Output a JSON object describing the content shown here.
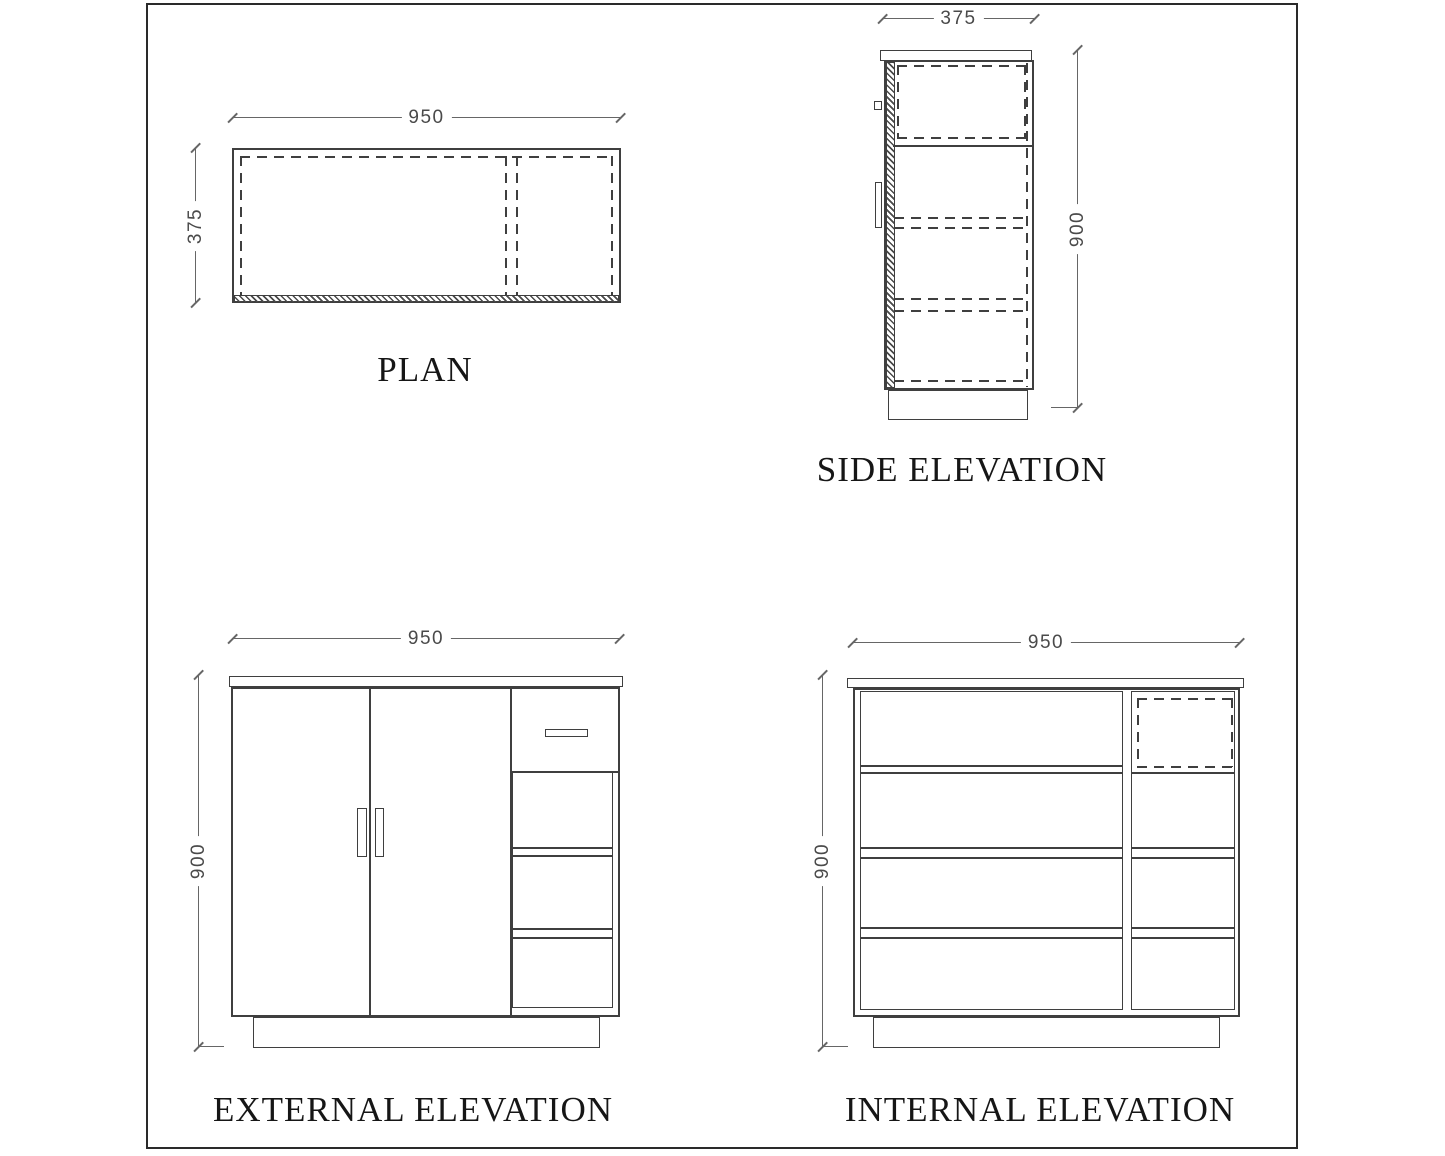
{
  "views": {
    "plan": {
      "title": "PLAN",
      "width_dim": "950",
      "depth_dim": "375"
    },
    "side": {
      "title": "SIDE ELEVATION",
      "width_dim": "375",
      "height_dim": "900"
    },
    "external": {
      "title": "EXTERNAL ELEVATION",
      "width_dim": "950",
      "height_dim": "900"
    },
    "internal": {
      "title": "INTERNAL ELEVATION",
      "width_dim": "950",
      "height_dim": "900"
    }
  },
  "colors": {
    "object_line": "#3f3f3f",
    "dimension_line": "#666666",
    "text": "#161616",
    "background": "#ffffff"
  }
}
